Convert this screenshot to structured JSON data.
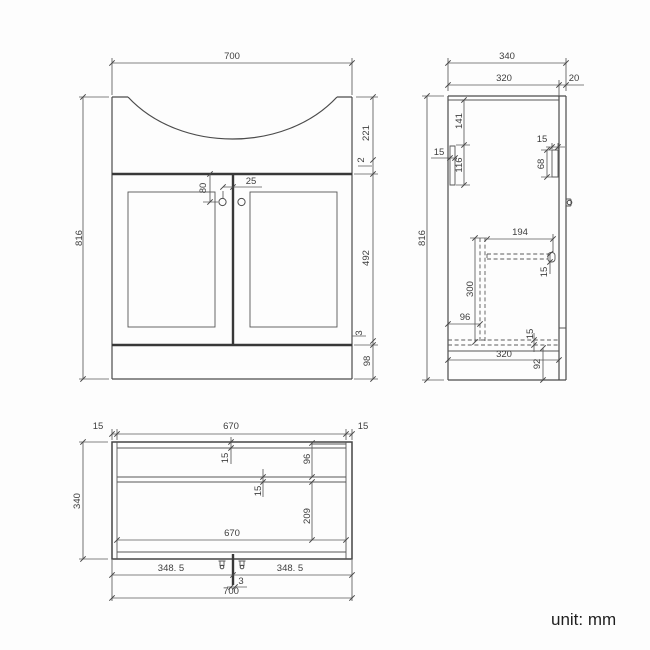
{
  "footer": {
    "unit_label": "unit: mm"
  },
  "front_view": {
    "dims": {
      "width": "700",
      "height": "816",
      "basin_height": "221",
      "countertop_lip": "2",
      "door_height": "492",
      "bottom_gap": "3",
      "plinth_height": "98",
      "handle_drop": "80",
      "handle_offset": "25"
    }
  },
  "side_view": {
    "dims": {
      "depth": "340",
      "carcass_depth": "320",
      "door_thickness": "20",
      "rail_drop": "141",
      "rail_height": "116",
      "rail_thickness": "15",
      "front_rail_thickness": "15",
      "front_rail_height": "68",
      "height": "816",
      "shelf_depth": "194",
      "shelf_thickness": "15",
      "back_panel_height": "300",
      "back_panel_offset": "96",
      "bottom_thickness": "15",
      "plinth_depth": "320",
      "plinth_height": "92"
    }
  },
  "plan_view": {
    "dims": {
      "left_wall_thickness": "15",
      "inner_width": "670",
      "right_wall_thickness": "15",
      "depth": "340",
      "back_thickness": "15",
      "back_rail_depth": "96",
      "shelf_thickness": "15",
      "front_depth": "209",
      "inner_width_front": "670",
      "door_width_left": "348. 5",
      "center_gap": "3",
      "door_width_right": "348. 5",
      "width": "700"
    }
  }
}
